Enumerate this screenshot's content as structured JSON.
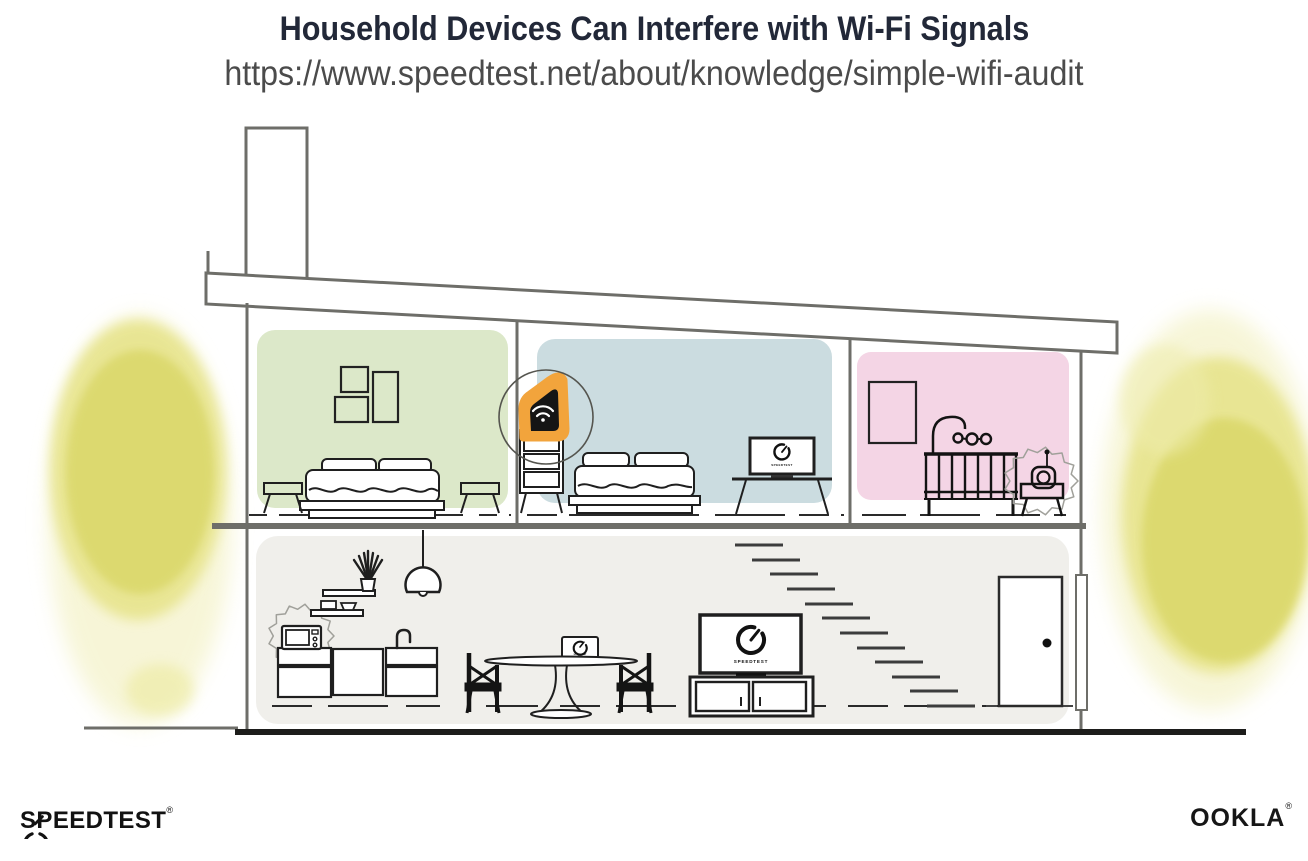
{
  "header": {
    "title": "Household Devices Can Interfere with Wi-Fi Signals",
    "url": "https://www.speedtest.net/about/knowledge/simple-wifi-audit"
  },
  "illustration": {
    "type": "house-cross-section",
    "depicted_objects": [
      "wifi-router",
      "microwave",
      "baby-monitor",
      "living-room-tv",
      "bedroom-tv",
      "dining-laptop",
      "beds",
      "crib",
      "staircase",
      "kitchen-counter",
      "pendant-lamp",
      "dining-table",
      "chairs",
      "door",
      "picture-frames",
      "foliage"
    ],
    "screen_labels": {
      "living_room_tv": "SPEEDTEST",
      "bedroom_tv": "SPEEDTEST",
      "dining_laptop": "SPEEDTEST"
    }
  },
  "footer": {
    "speedtest": {
      "label": "SPEEDTEST",
      "mark": "®"
    },
    "ookla": {
      "label": "OOKLA",
      "mark": "®"
    }
  },
  "colors": {
    "title_text": "#222838",
    "url_text": "#4b4b4b",
    "room_green": "#dce8c9",
    "room_blue": "#cbdce0",
    "room_pink": "#f4d5e5",
    "lower_floor_gray": "#f0efeb",
    "router_glow_orange": "#f2a43c",
    "foliage_yellow": "#dedc72",
    "structure_line": "#6e6e69",
    "ink": "#1c1c1c"
  }
}
